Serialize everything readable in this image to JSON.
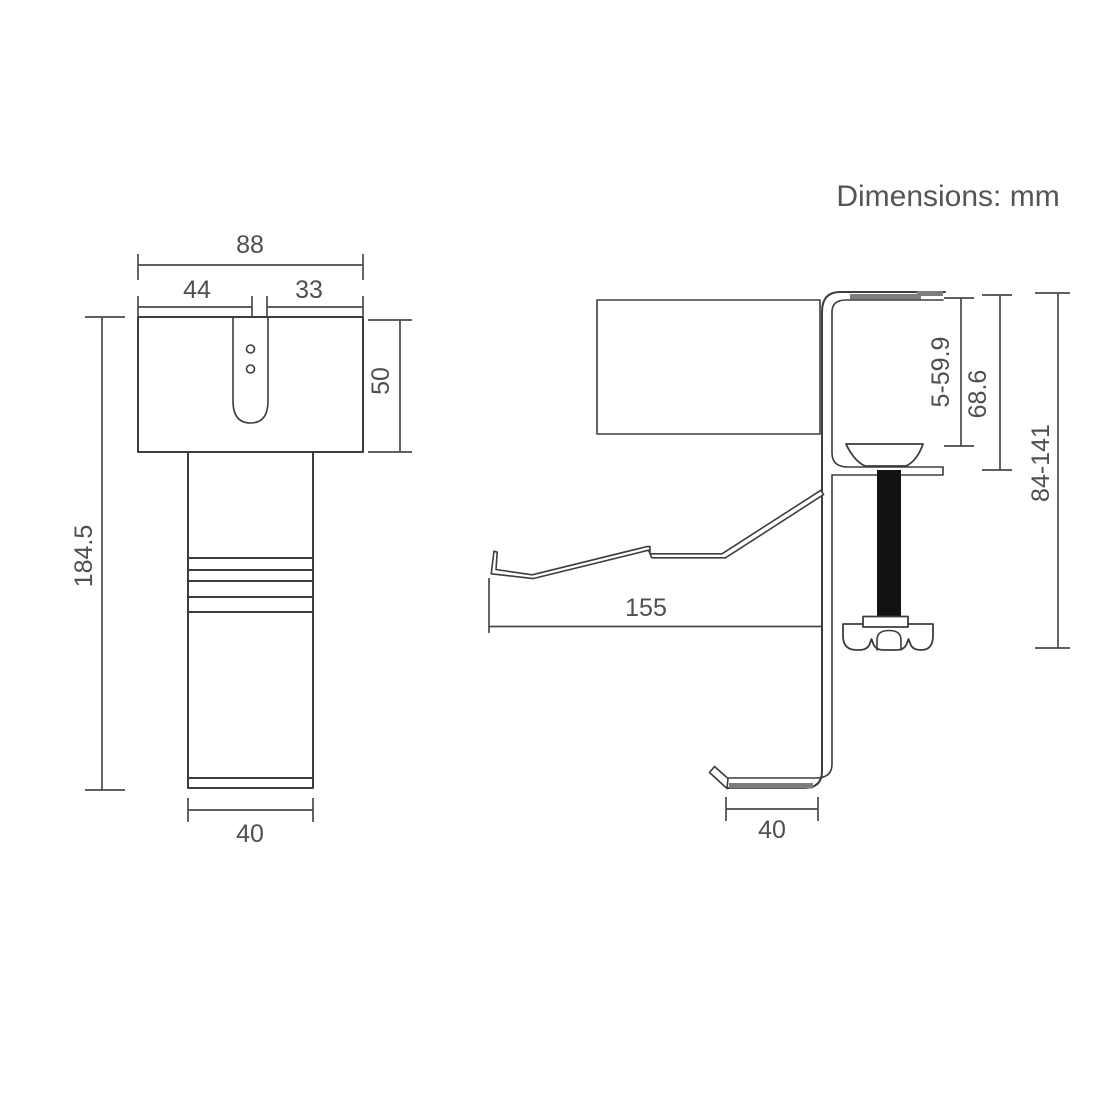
{
  "note": "Dimensions: mm",
  "front_view": {
    "top_width": "88",
    "slot_offset_left": "44",
    "slot_offset_right": "33",
    "head_height": "50",
    "total_height": "184.5",
    "pole_width": "40"
  },
  "side_view": {
    "arm_length": "155",
    "clamp_opening_range": "5-59.9",
    "clamp_inner_height": "68.6",
    "overall_height_range": "84-141",
    "hook_width": "40"
  },
  "colors": {
    "line": "#3d3d3d",
    "dimension_line": "#4a4a4a",
    "text": "#4f4f4f",
    "rubber_pad": "#7d7d7d",
    "screw_rod": "#121212",
    "background": "#ffffff"
  }
}
